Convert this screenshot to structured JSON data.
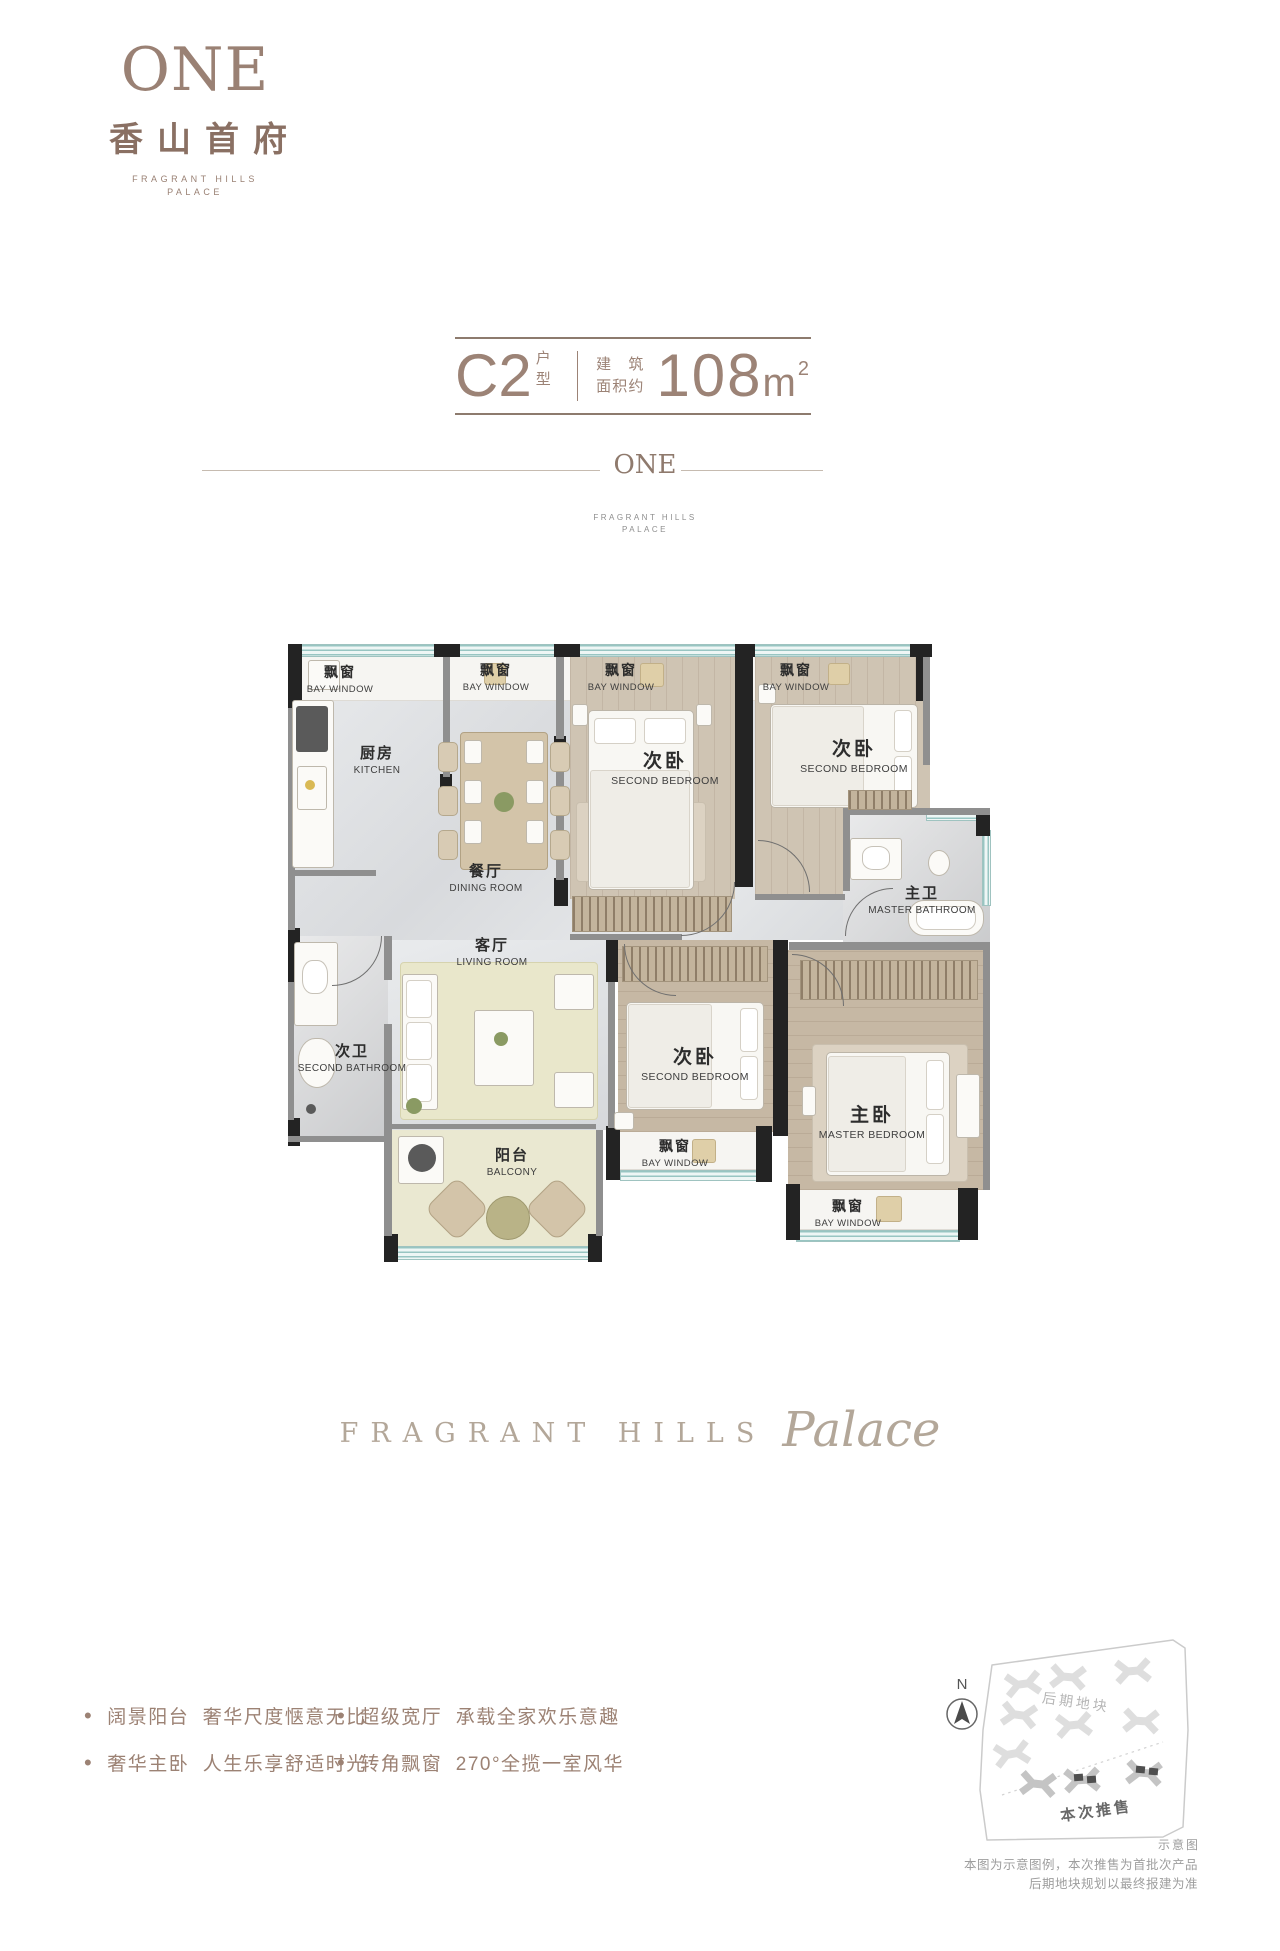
{
  "logo": {
    "one": "ONE",
    "cn": "香山首府",
    "en_line1": "FRAGRANT HILLS",
    "en_line2": "PALACE"
  },
  "title": {
    "unit": "C2",
    "unit_tag": "户型",
    "area_label_line1": "建筑",
    "area_label_line2": "面积约",
    "area_value": "108",
    "area_unit": "m",
    "area_sup": "2"
  },
  "divider": {
    "logo": "ONE",
    "sub_line1": "FRAGRANT HILLS",
    "sub_line2": "PALACE"
  },
  "floorplan": {
    "bay_window": {
      "cn": "飘窗",
      "en": "BAY WINDOW"
    },
    "rooms": {
      "kitchen": {
        "cn": "厨房",
        "en": "KITCHEN"
      },
      "dining": {
        "cn": "餐厅",
        "en": "DINING ROOM"
      },
      "living": {
        "cn": "客厅",
        "en": "LIVING ROOM"
      },
      "balcony": {
        "cn": "阳台",
        "en": "BALCONY"
      },
      "bedroom_a": {
        "cn": "次卧",
        "en": "SECOND BEDROOM"
      },
      "bedroom_b": {
        "cn": "次卧",
        "en": "SECOND BEDROOM"
      },
      "bedroom_c": {
        "cn": "次卧",
        "en": "SECOND BEDROOM"
      },
      "master_bedroom": {
        "cn": "主卧",
        "en": "MASTER BEDROOM"
      },
      "master_bath": {
        "cn": "主卫",
        "en": "MASTER BATHROOM"
      },
      "second_bath": {
        "cn": "次卫",
        "en": "SECOND BATHROOM"
      }
    }
  },
  "tagline": {
    "caps": "FRAGRANT HILLS",
    "script": "Palace"
  },
  "features": {
    "bullet": "•",
    "items": [
      "阔景阳台  奢华尺度惬意无比",
      "超级宽厅  承载全家欢乐意趣",
      "奢华主卧  人生乐享舒适时光",
      "转角飘窗  270°全揽一室风华"
    ]
  },
  "siteplan": {
    "compass_n": "N",
    "phase_later_label": "后期地块",
    "phase_current_label": "本次推售",
    "caption": "示意图",
    "disclaimer_line1": "本图为示意图例，本次推售为首批次产品",
    "disclaimer_line2": "后期地块规划以最终报建为准"
  },
  "colors": {
    "brand": "#9a8174",
    "title_text": "#9c8376",
    "feature_text": "#9c8274",
    "plan_text": "#2d2d2d",
    "window_teal": "#9dc6c3",
    "wall_dark": "#232323",
    "tagline": "#b3a799",
    "site_gray": "#dedede"
  }
}
